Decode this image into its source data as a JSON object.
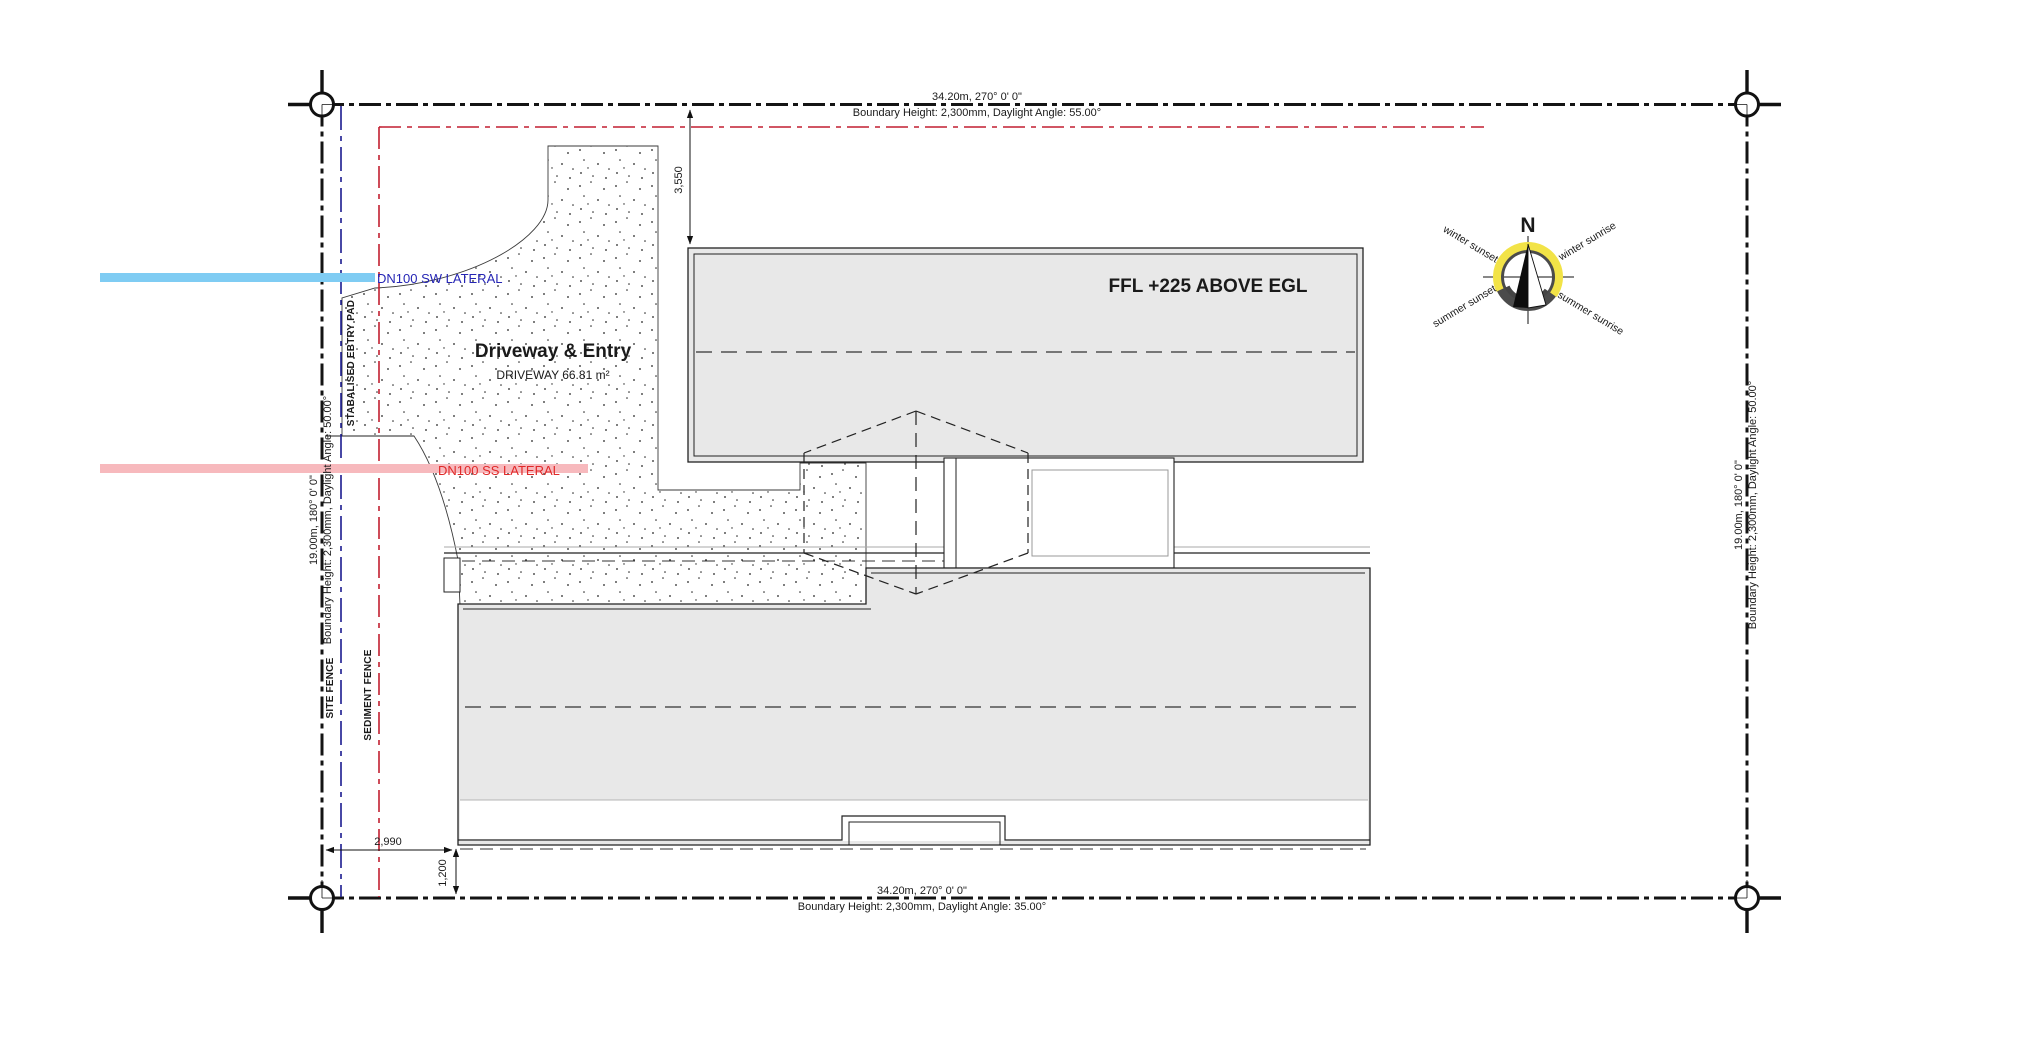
{
  "plan": {
    "boundaries": {
      "top": {
        "dimension": "34.20m, 270° 0' 0\"",
        "note": "Boundary Height: 2,300mm, Daylight Angle: 55.00°"
      },
      "bottom": {
        "dimension": "34.20m, 270° 0' 0\"",
        "note": "Boundary Height: 2,300mm, Daylight Angle: 35.00°"
      },
      "left": {
        "dimension": "19.00m, 180° 0' 0\"",
        "note": "Boundary Height: 2,300mm, Daylight Angle: 50.00°"
      },
      "right": {
        "dimension": "19.00m, 180° 0' 0\"",
        "note": "Boundary Height: 2,300mm, Daylight Angle: 50.00°"
      }
    },
    "services": {
      "sw_lateral": "DN100 SW LATERAL",
      "ss_lateral": "DN100 SS LATERAL"
    },
    "fences": {
      "site": "SITE FENCE",
      "sediment": "SEDIMENT FENCE",
      "entry_pad": "STABALISED EBTRY PAD"
    },
    "areas": {
      "driveway_title": "Driveway & Entry",
      "driveway_area": "DRIVEWAY 66.81 m²",
      "ffl_note": "FFL +225 ABOVE  EGL"
    },
    "dimensions": {
      "front_setback": "3,550",
      "side_setback": "2,990",
      "rear_setback": "1,200"
    },
    "compass": {
      "north": "N",
      "winter_sunset": "winter sunset",
      "winter_sunrise": "winter sunrise",
      "summer_sunset": "summer sunset",
      "summer_sunrise": "summer sunrise"
    },
    "colors": {
      "roof_fill": "#e8e8e8",
      "sw_lateral_band": "#7fccf3",
      "sw_lateral_text": "#2525b5",
      "ss_lateral_band": "#f7b9bd",
      "ss_lateral_text": "#e02828",
      "site_fence_line": "#1b1b8f",
      "sediment_fence_line": "#c21f30",
      "compass_yellow": "#f2e347",
      "compass_ring": "#4b4b4b"
    }
  }
}
